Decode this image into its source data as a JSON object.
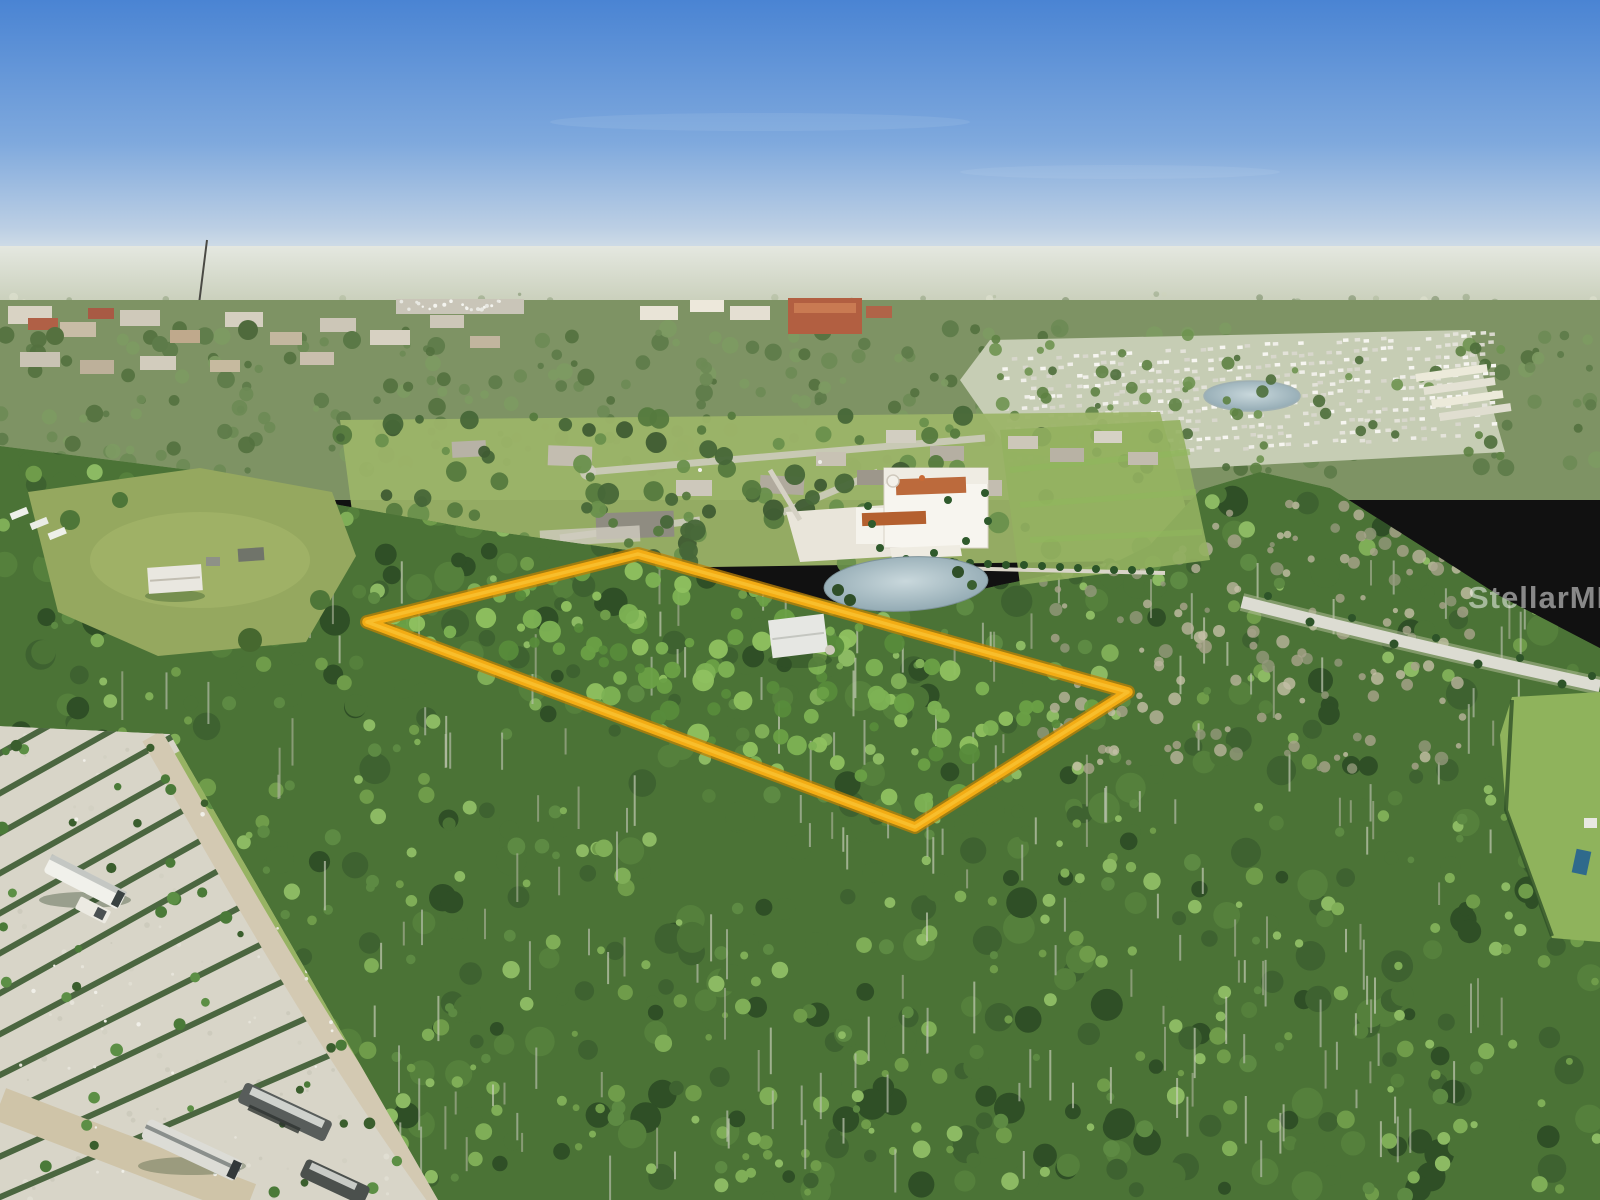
{
  "watermark": {
    "text": "StellarMLS"
  },
  "annotation": {
    "label": "highlighted property parcel boundary",
    "points": "367,622 638,554 1128,692 915,827",
    "stroke_color": "#F3AC14",
    "edge_color": "#BD8206",
    "highlight_color": "#FFD54A"
  },
  "palette": {
    "sky_top": "#4A84D3",
    "sky_mid": "#7FA9DD",
    "sky_horizon": "#DCE4E8",
    "forest_base": "#4B7336",
    "canopy_light": "#7FAE57",
    "water": "#AEBEC4",
    "gravel": "#D8D5C8",
    "boundary_gold": "#F3AC14"
  }
}
